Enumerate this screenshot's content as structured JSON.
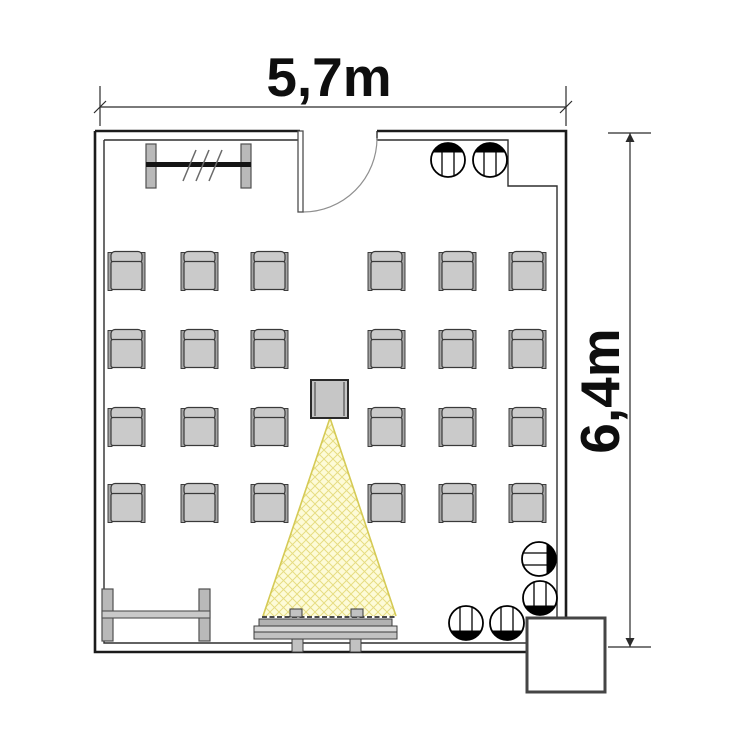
{
  "dimensions": {
    "width": {
      "label": "5,7m"
    },
    "height": {
      "label": "6,4m"
    }
  },
  "room": {
    "type": "seminar room floor plan",
    "armchair_count": 24,
    "round_chair_count": 6
  },
  "colors": {
    "wall_outer": "#1b1b1b",
    "wall_inner": "#2e2e2e",
    "chair_fill": "#cacaca",
    "chair_stroke": "#3a3a3a",
    "armrest_fill": "#a6a6a6",
    "armrest_stroke": "#2f2f2f",
    "post_fill": "#b9b9b9",
    "post_stroke": "#4f4f4f",
    "rack_bar": "#141414",
    "bench_bar": "#c9c9c9",
    "projector_fill": "#c6c6c6",
    "projector_stroke": "#2b2b2b",
    "projector_inner": "#7f7f7f",
    "cone_fill": "#fdfbd8",
    "cone_hatch": "#e6dd82",
    "cone_edge": "#d5ca55",
    "screen_dark": "#b2b2b2",
    "screen_light": "#d8d8d8",
    "screen_mid": "#c2c2c2",
    "screen_stroke": "#3c3c3c",
    "annex_stroke": "#454545",
    "dim_stroke": "#2a2a2a"
  },
  "furniture": {
    "armchairs": {
      "count": 24,
      "cols_x": [
        108,
        181,
        251,
        368,
        439,
        509
      ],
      "rows_y": [
        251,
        329,
        407,
        483
      ]
    },
    "round_chairs": {
      "count": 6,
      "items": [
        {
          "x": 448,
          "y": 160,
          "rot": 0
        },
        {
          "x": 490,
          "y": 160,
          "rot": 0
        },
        {
          "x": 539,
          "y": 559,
          "rot": 90
        },
        {
          "x": 540,
          "y": 598,
          "rot": 180
        },
        {
          "x": 466,
          "y": 623,
          "rot": 180
        },
        {
          "x": 507,
          "y": 623,
          "rot": 180
        }
      ]
    },
    "coat_rack": {
      "posts": [
        {
          "x": 146,
          "y": 144
        },
        {
          "x": 241,
          "y": 144
        }
      ],
      "post_w": 10,
      "post_h": 44,
      "bar": {
        "x": 146,
        "y": 162,
        "w": 105,
        "h": 5
      },
      "slash_count": 3,
      "slash_start_x": 183,
      "slash_dx": 13,
      "slash_y1": 181,
      "slash_y2": 150
    },
    "bench": {
      "posts": [
        {
          "x": 102,
          "y": 589
        },
        {
          "x": 199,
          "y": 589
        }
      ],
      "post_w": 11,
      "post_h": 52,
      "bar": {
        "x": 102,
        "y": 611,
        "w": 108,
        "h": 7
      }
    },
    "projector": {
      "x": 311,
      "y": 380,
      "w": 37,
      "h": 38
    },
    "light_cone": {
      "apex": [
        330,
        418
      ],
      "base_left": [
        263,
        616
      ],
      "base_right": [
        396,
        616
      ]
    },
    "screen": {
      "x": 254,
      "y": 609,
      "w": 143
    }
  }
}
